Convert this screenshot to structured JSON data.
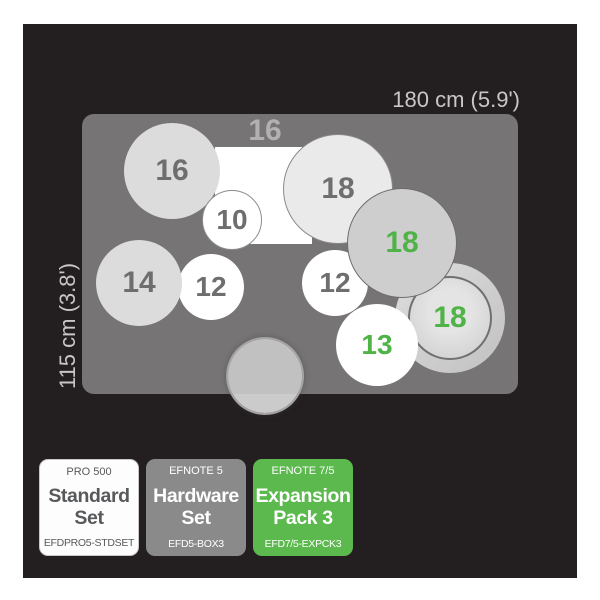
{
  "kit": {
    "area_width_label": "180 cm (5.9')",
    "area_height_label": "115 cm (3.8')",
    "rect_label": "16",
    "drums": [
      {
        "id": "crash-16-top-left",
        "size": "16",
        "label_color": "gray"
      },
      {
        "id": "tom-10",
        "size": "10",
        "label_color": "gray"
      },
      {
        "id": "crash-18-top",
        "size": "18",
        "label_color": "gray"
      },
      {
        "id": "ride-18-gray",
        "size": "18",
        "label_color": "green"
      },
      {
        "id": "tom-14",
        "size": "14",
        "label_color": "gray"
      },
      {
        "id": "tom-12-left",
        "size": "12",
        "label_color": "gray"
      },
      {
        "id": "tom-12-right",
        "size": "12",
        "label_color": "gray"
      },
      {
        "id": "cymbal-18-ring",
        "size": "18",
        "label_color": "green"
      },
      {
        "id": "tom-13",
        "size": "13",
        "label_color": "green"
      },
      {
        "id": "kick-drum",
        "size": "",
        "label_color": ""
      }
    ]
  },
  "legend": {
    "cards": [
      {
        "series": "PRO 500",
        "title": "Standard Set",
        "code": "EFDPRO5-STDSET",
        "style": "white"
      },
      {
        "series": "EFNOTE 5",
        "title": "Hardware Set",
        "code": "EFD5-BOX3",
        "style": "gray"
      },
      {
        "series": "EFNOTE 7/5",
        "title": "Expansion Pack 3",
        "code": "EFD7/5-EXPCK3",
        "style": "green"
      }
    ]
  },
  "colors": {
    "panel_background": "#231f20",
    "rug": "#767474",
    "accent_green_box": "#5cb94e",
    "green_number_text": "#4fb347",
    "gray_number_text": "#6e6e6e",
    "dimension_text": "#c8c6c6"
  }
}
